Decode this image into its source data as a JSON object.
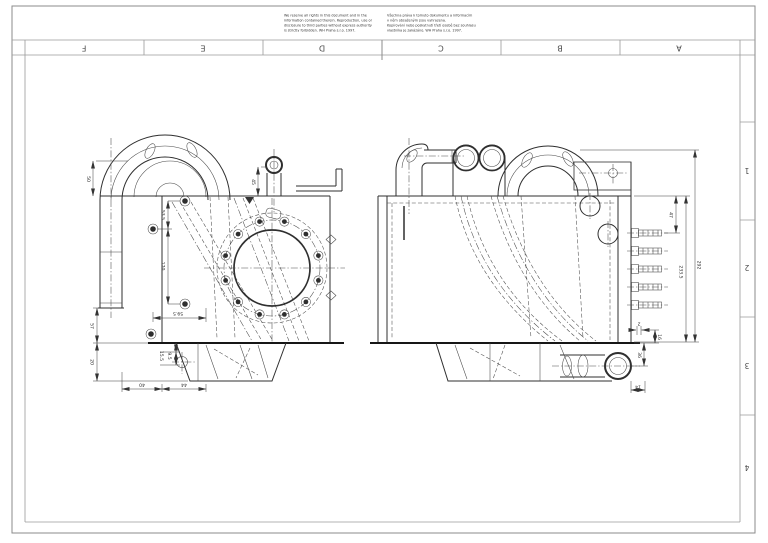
{
  "sheet": {
    "background": "#ffffff",
    "drawing_line_color": "#2f2f2f",
    "frame_line_color": "#8b8b8b"
  },
  "frame": {
    "columns": [
      "F",
      "E",
      "D",
      "C",
      "B",
      "A"
    ],
    "rows": [
      "1",
      "2",
      "3",
      "4"
    ]
  },
  "notices": {
    "en": [
      "We reserve all rights in this document and in the",
      "information contained therein. Reproduction, use or",
      "disclosure to third parties without express authority",
      "is strictly forbidden. WH Praha s.r.o. 1997."
    ],
    "cs": [
      "Všechna práva k tomuto dokumentu a informacím",
      "v něm obsaženým jsou vyhrazena.",
      "Kopírování nebo poskytnutí třetí osobě bez souhlasu",
      "vlastníka je zakázáno. WH Praha s.r.o. 1997."
    ]
  },
  "views": {
    "front": {
      "name": "front-view",
      "dims": {
        "d50": "50",
        "d45": "45",
        "d53_5": "53.5",
        "d170": "170",
        "d59_5": "59.5",
        "d57": "57",
        "d20": "20",
        "d15_5": "15.5",
        "d9_5": "9.5",
        "d40": "40",
        "d44": "44"
      }
    },
    "side": {
      "name": "side-view",
      "dims": {
        "d47": "47",
        "d292": "292",
        "d233_5": "233.5",
        "d2": "2",
        "d16": "16",
        "d36": "36",
        "d14": "14"
      }
    }
  }
}
